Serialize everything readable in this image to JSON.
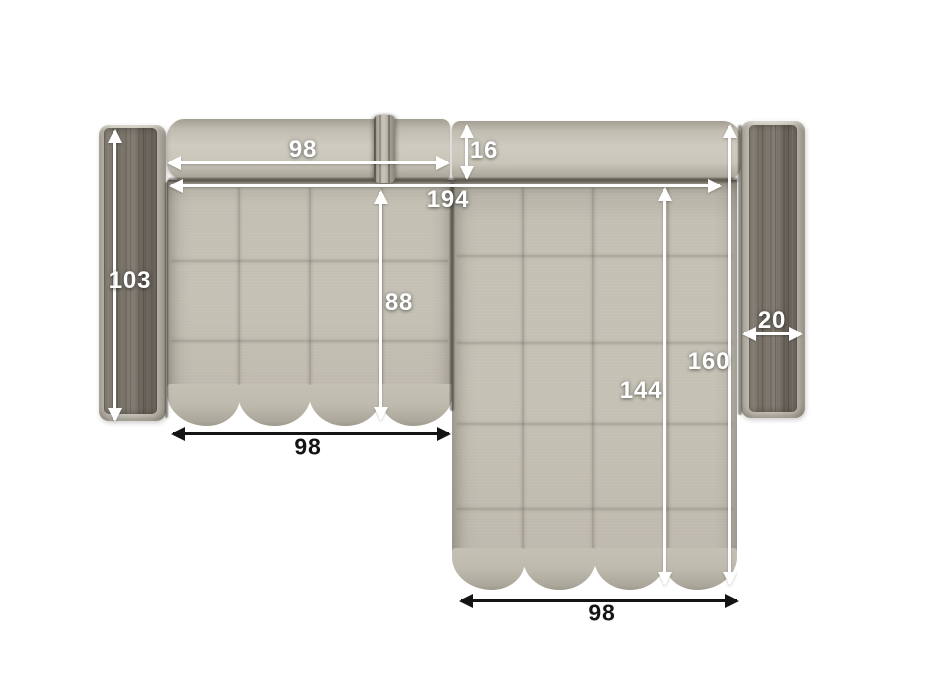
{
  "diagram": {
    "type": "corner-sofa-top-view-dimensions",
    "background": "#ffffff",
    "colors": {
      "fabric": "#c6c2b6",
      "fabric_shadow": "#9c988c",
      "wood": "#756f66",
      "dim_white": "#ffffff",
      "dim_black": "#141414"
    },
    "dims": {
      "back_cushion_width": "98",
      "back_depth": "16",
      "inner_width": "194",
      "left_armrest_length": "103",
      "left_seat_depth": "88",
      "left_seat_width": "98",
      "chaise_total_length": "160",
      "chaise_seat_length": "144",
      "armrest_width": "20",
      "chaise_width": "98"
    }
  }
}
